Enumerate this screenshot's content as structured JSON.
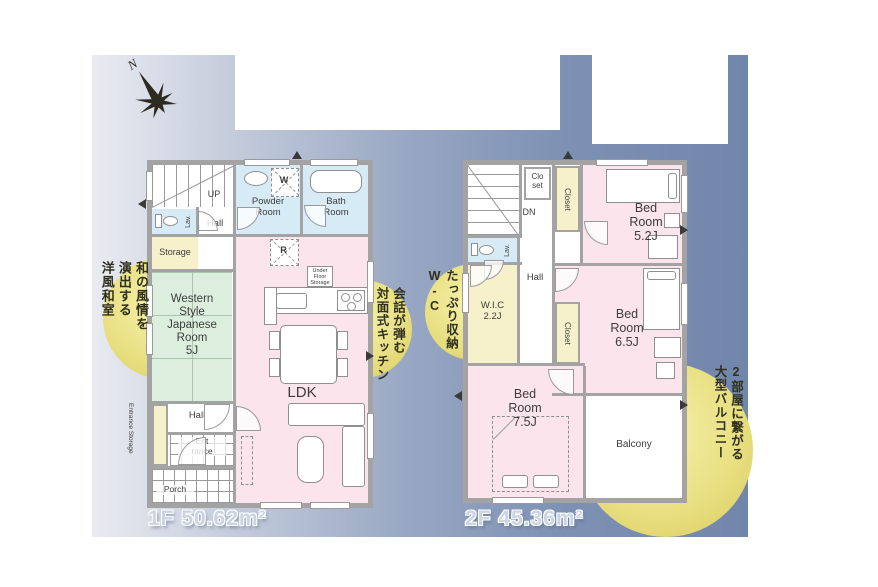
{
  "compass": {
    "north_label": "N"
  },
  "callouts": {
    "japanese_room": "和の風情を\n演出する\n洋風和室",
    "kitchen": "会話が弾む\n対面式キッチン",
    "storage_wc": "たっぷり収納\nW-C",
    "balcony": "2部屋に繋がる\n大型バルコニー"
  },
  "floor1": {
    "area_label": "1F 50.62m²",
    "rooms": {
      "stairs_up": "UP",
      "lavatory": "Lav.",
      "hall_upper": "Hall",
      "powder_room": "Powder\nRoom",
      "washer": "W",
      "bath_room": "Bath\nRoom",
      "storage": "Storage",
      "japanese_room": "Western\nStyle\nJapanese\nRoom\n5J",
      "refrigerator": "R",
      "under_floor_storage": "Under\nFloor\nStorage",
      "ldk": "LDK\n16J",
      "hall_lower": "Hall",
      "entrance": "Ent\nrance",
      "entrance_storage": "Entrance Storage",
      "porch": "Porch"
    }
  },
  "floor2": {
    "area_label": "2F 45.36m²",
    "rooms": {
      "stairs_down": "DN",
      "closet_small": "Clo\nset",
      "closet_upper": "Closet",
      "bedroom_52": "Bed\nRoom\n5.2J",
      "lavatory": "Lav.",
      "wic": "W.I.C\n2.2J",
      "hall": "Hall",
      "closet_middle": "Closet",
      "bedroom_65": "Bed\nRoom\n6.5J",
      "bedroom_75": "Bed\nRoom\n7.5J",
      "balcony": "Balcony"
    }
  },
  "palette": {
    "background_blue": "#7186ab",
    "background_light": "#e9ebf1",
    "callout_yellow": "#e6dd7a",
    "room_pink": "#fbe4ec",
    "room_blue": "#d6ebf6",
    "room_green": "#dcefde",
    "room_yellow": "#f6f1cb",
    "wall_gray": "#a3a3a3"
  }
}
